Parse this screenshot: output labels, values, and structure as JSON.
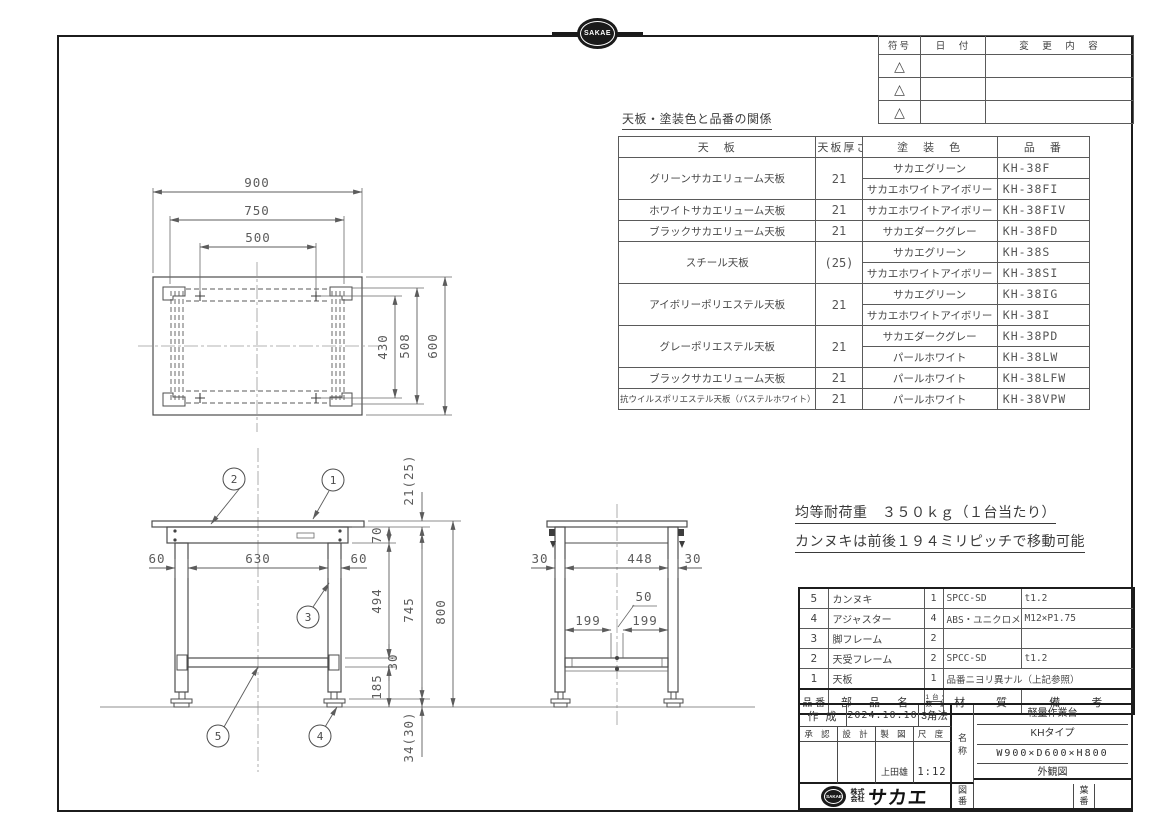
{
  "page": {
    "badge_text": "SAKAE"
  },
  "revision_table": {
    "headers": {
      "symbol": "符号",
      "date": "日　付",
      "change": "変　更　内　容"
    },
    "row_symbol": "△"
  },
  "spec_table": {
    "title": "天板・塗装色と品番の関係",
    "headers": {
      "top": "天　板",
      "thickness": "天板厚さ",
      "color": "塗　装　色",
      "code": "品　番"
    },
    "groups": [
      {
        "name": "グリーンサカエリューム天板",
        "thickness": "21",
        "rows": [
          {
            "color": "サカエグリーン",
            "code": "KH-38F"
          },
          {
            "color": "サカエホワイトアイボリー",
            "code": "KH-38FI"
          }
        ]
      },
      {
        "name": "ホワイトサカエリューム天板",
        "thickness": "21",
        "rows": [
          {
            "color": "サカエホワイトアイボリー",
            "code": "KH-38FIV"
          }
        ]
      },
      {
        "name": "ブラックサカエリューム天板",
        "thickness": "21",
        "rows": [
          {
            "color": "サカエダークグレー",
            "code": "KH-38FD"
          }
        ]
      },
      {
        "name": "スチール天板",
        "thickness": "(25)",
        "rows": [
          {
            "color": "サカエグリーン",
            "code": "KH-38S"
          },
          {
            "color": "サカエホワイトアイボリー",
            "code": "KH-38SI"
          }
        ]
      },
      {
        "name": "アイボリーポリエステル天板",
        "thickness": "21",
        "rows": [
          {
            "color": "サカエグリーン",
            "code": "KH-38IG"
          },
          {
            "color": "サカエホワイトアイボリー",
            "code": "KH-38I"
          }
        ]
      },
      {
        "name": "グレーポリエステル天板",
        "thickness": "21",
        "rows": [
          {
            "color": "サカエダークグレー",
            "code": "KH-38PD"
          },
          {
            "color": "パールホワイト",
            "code": "KH-38LW"
          }
        ]
      },
      {
        "name": "ブラックサカエリューム天板",
        "thickness": "21",
        "rows": [
          {
            "color": "パールホワイト",
            "code": "KH-38LFW"
          }
        ]
      },
      {
        "name": "抗ウイルスポリエステル天板（パステルホワイト）",
        "thickness": "21",
        "rows": [
          {
            "color": "パールホワイト",
            "code": "KH-38VPW"
          }
        ]
      }
    ]
  },
  "notes": {
    "line1": "均等耐荷重　３５０ｋｇ（１台当たり）",
    "line2": "カンヌキは前後１９４ミリピッチで移動可能"
  },
  "drawing": {
    "balloons": [
      "1",
      "2",
      "3",
      "4",
      "5"
    ],
    "dims": {
      "top": {
        "w900": "900",
        "w750": "750",
        "w500": "500",
        "d430": "430",
        "d508": "508",
        "d600": "600"
      },
      "front": {
        "leg_w_l": "60",
        "span": "630",
        "leg_w_r": "60",
        "top_thk": "21(25)",
        "apron_h": "70",
        "mid_h": "494",
        "bar_h": "30",
        "low_h": "185",
        "frame_h": "745",
        "total_h": "800",
        "adj_h": "34(30)"
      },
      "side": {
        "leg_d_l": "30",
        "span": "448",
        "leg_d_r": "30",
        "pitch_l": "199",
        "pitch_r": "199",
        "slot": "50"
      }
    }
  },
  "parts_table": {
    "headers": {
      "no": "品 番",
      "name": "部　品　名",
      "qty_top": "1台分",
      "qty_bottom": "数 量",
      "material": "材　　質",
      "remark": "備　　考"
    },
    "rows": [
      {
        "no": "5",
        "name": "カンヌキ",
        "qty": "1",
        "material": "SPCC-SD",
        "remark": "t1.2"
      },
      {
        "no": "4",
        "name": "アジャスター",
        "qty": "4",
        "material": "ABS・ユニクロメッキ",
        "remark": "M12×P1.75"
      },
      {
        "no": "3",
        "name": "脚フレーム",
        "qty": "2",
        "material": "",
        "remark": ""
      },
      {
        "no": "2",
        "name": "天受フレーム",
        "qty": "2",
        "material": "SPCC-SD",
        "remark": "t1.2"
      },
      {
        "no": "1",
        "name": "天板",
        "qty": "1",
        "material": "品番ニヨリ異ナル（上記参照）",
        "remark": ""
      }
    ]
  },
  "title_block": {
    "created_label": "作 成",
    "created_date": "2024.10.10",
    "projection": "3角法",
    "approved_label": "承 認",
    "design_label": "設 計",
    "draft_label": "製 図",
    "scale_label": "尺 度",
    "drafter": "上田雄",
    "scale": "1:12",
    "name_label_top": "名",
    "name_label_bottom": "称",
    "product_name": "軽量作業台",
    "product_type": "KHタイプ",
    "product_size": "W900×D600×H800",
    "drawing_type": "外観図",
    "company_prefix_top": "株式",
    "company_prefix_bottom": "会社",
    "company_name": "サカエ",
    "drawing_no_label_top": "図",
    "drawing_no_label_bottom": "番",
    "sheet_no_label_top": "葉",
    "sheet_no_label_bottom": "番"
  }
}
